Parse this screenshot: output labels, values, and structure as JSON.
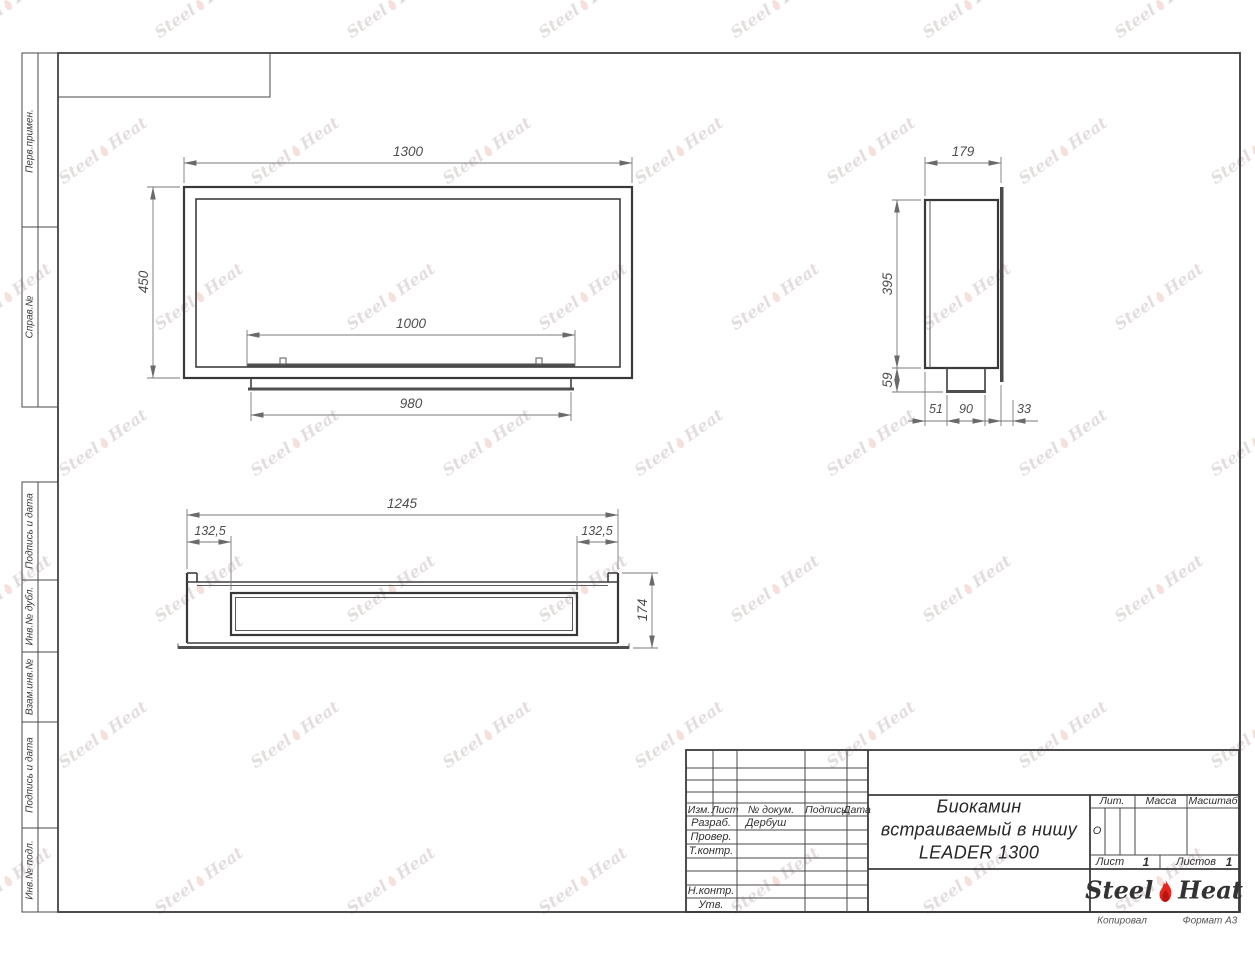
{
  "sheet": {
    "copied": "Копировал",
    "format": "Формат А3"
  },
  "left_stamps": {
    "top": [
      "Перв.примен.",
      "Справ.№"
    ],
    "bottom": [
      "Подпись и дата",
      "Инв.№ дубл.",
      "Взам.инв.№",
      "Подпись и дата",
      "Инв.№ подл."
    ]
  },
  "title_block": {
    "cols": [
      "Изм.",
      "Лист",
      "№ докум.",
      "Подпись",
      "Дата"
    ],
    "rows": [
      {
        "l": "Разраб.",
        "v": "Дербуш"
      },
      {
        "l": "Провер.",
        "v": ""
      },
      {
        "l": "Т.контр.",
        "v": ""
      },
      {
        "l": "",
        "v": ""
      },
      {
        "l": "",
        "v": ""
      },
      {
        "l": "Н.контр.",
        "v": ""
      },
      {
        "l": "Утв.",
        "v": ""
      }
    ],
    "title1": "Биокамин",
    "title2": "встраиваемый в нишу",
    "title3": "LEADER 1300",
    "lit": "Лит.",
    "lit_val": "О",
    "mass": "Масса",
    "scale": "Масштаб",
    "sheet_label": "Лист",
    "sheet_num": "1",
    "sheets_label": "Листов",
    "sheets_num": "1"
  },
  "logo": {
    "p1": "Steel",
    "p2": "Heat",
    "flame_color": "#e8251d"
  },
  "watermark": {
    "p1": "Steel",
    "p2": "Heat",
    "grid": {
      "rows": 7,
      "cols": 7,
      "x0": -45,
      "y0": -5,
      "dx": 192,
      "dy": 146,
      "stagger": 96
    }
  },
  "views": {
    "front": {
      "dims": {
        "width": "1300",
        "height": "450",
        "opening": "1000",
        "tray": "980"
      }
    },
    "side": {
      "dims": {
        "depth": "179",
        "height": "395",
        "tray_height": "59",
        "tray_offset": "51",
        "tray_width": "90",
        "flange_gap": "33"
      }
    },
    "bottom": {
      "dims": {
        "width": "1245",
        "left_inset": "132,5",
        "right_inset": "132,5",
        "depth": "174"
      }
    }
  }
}
